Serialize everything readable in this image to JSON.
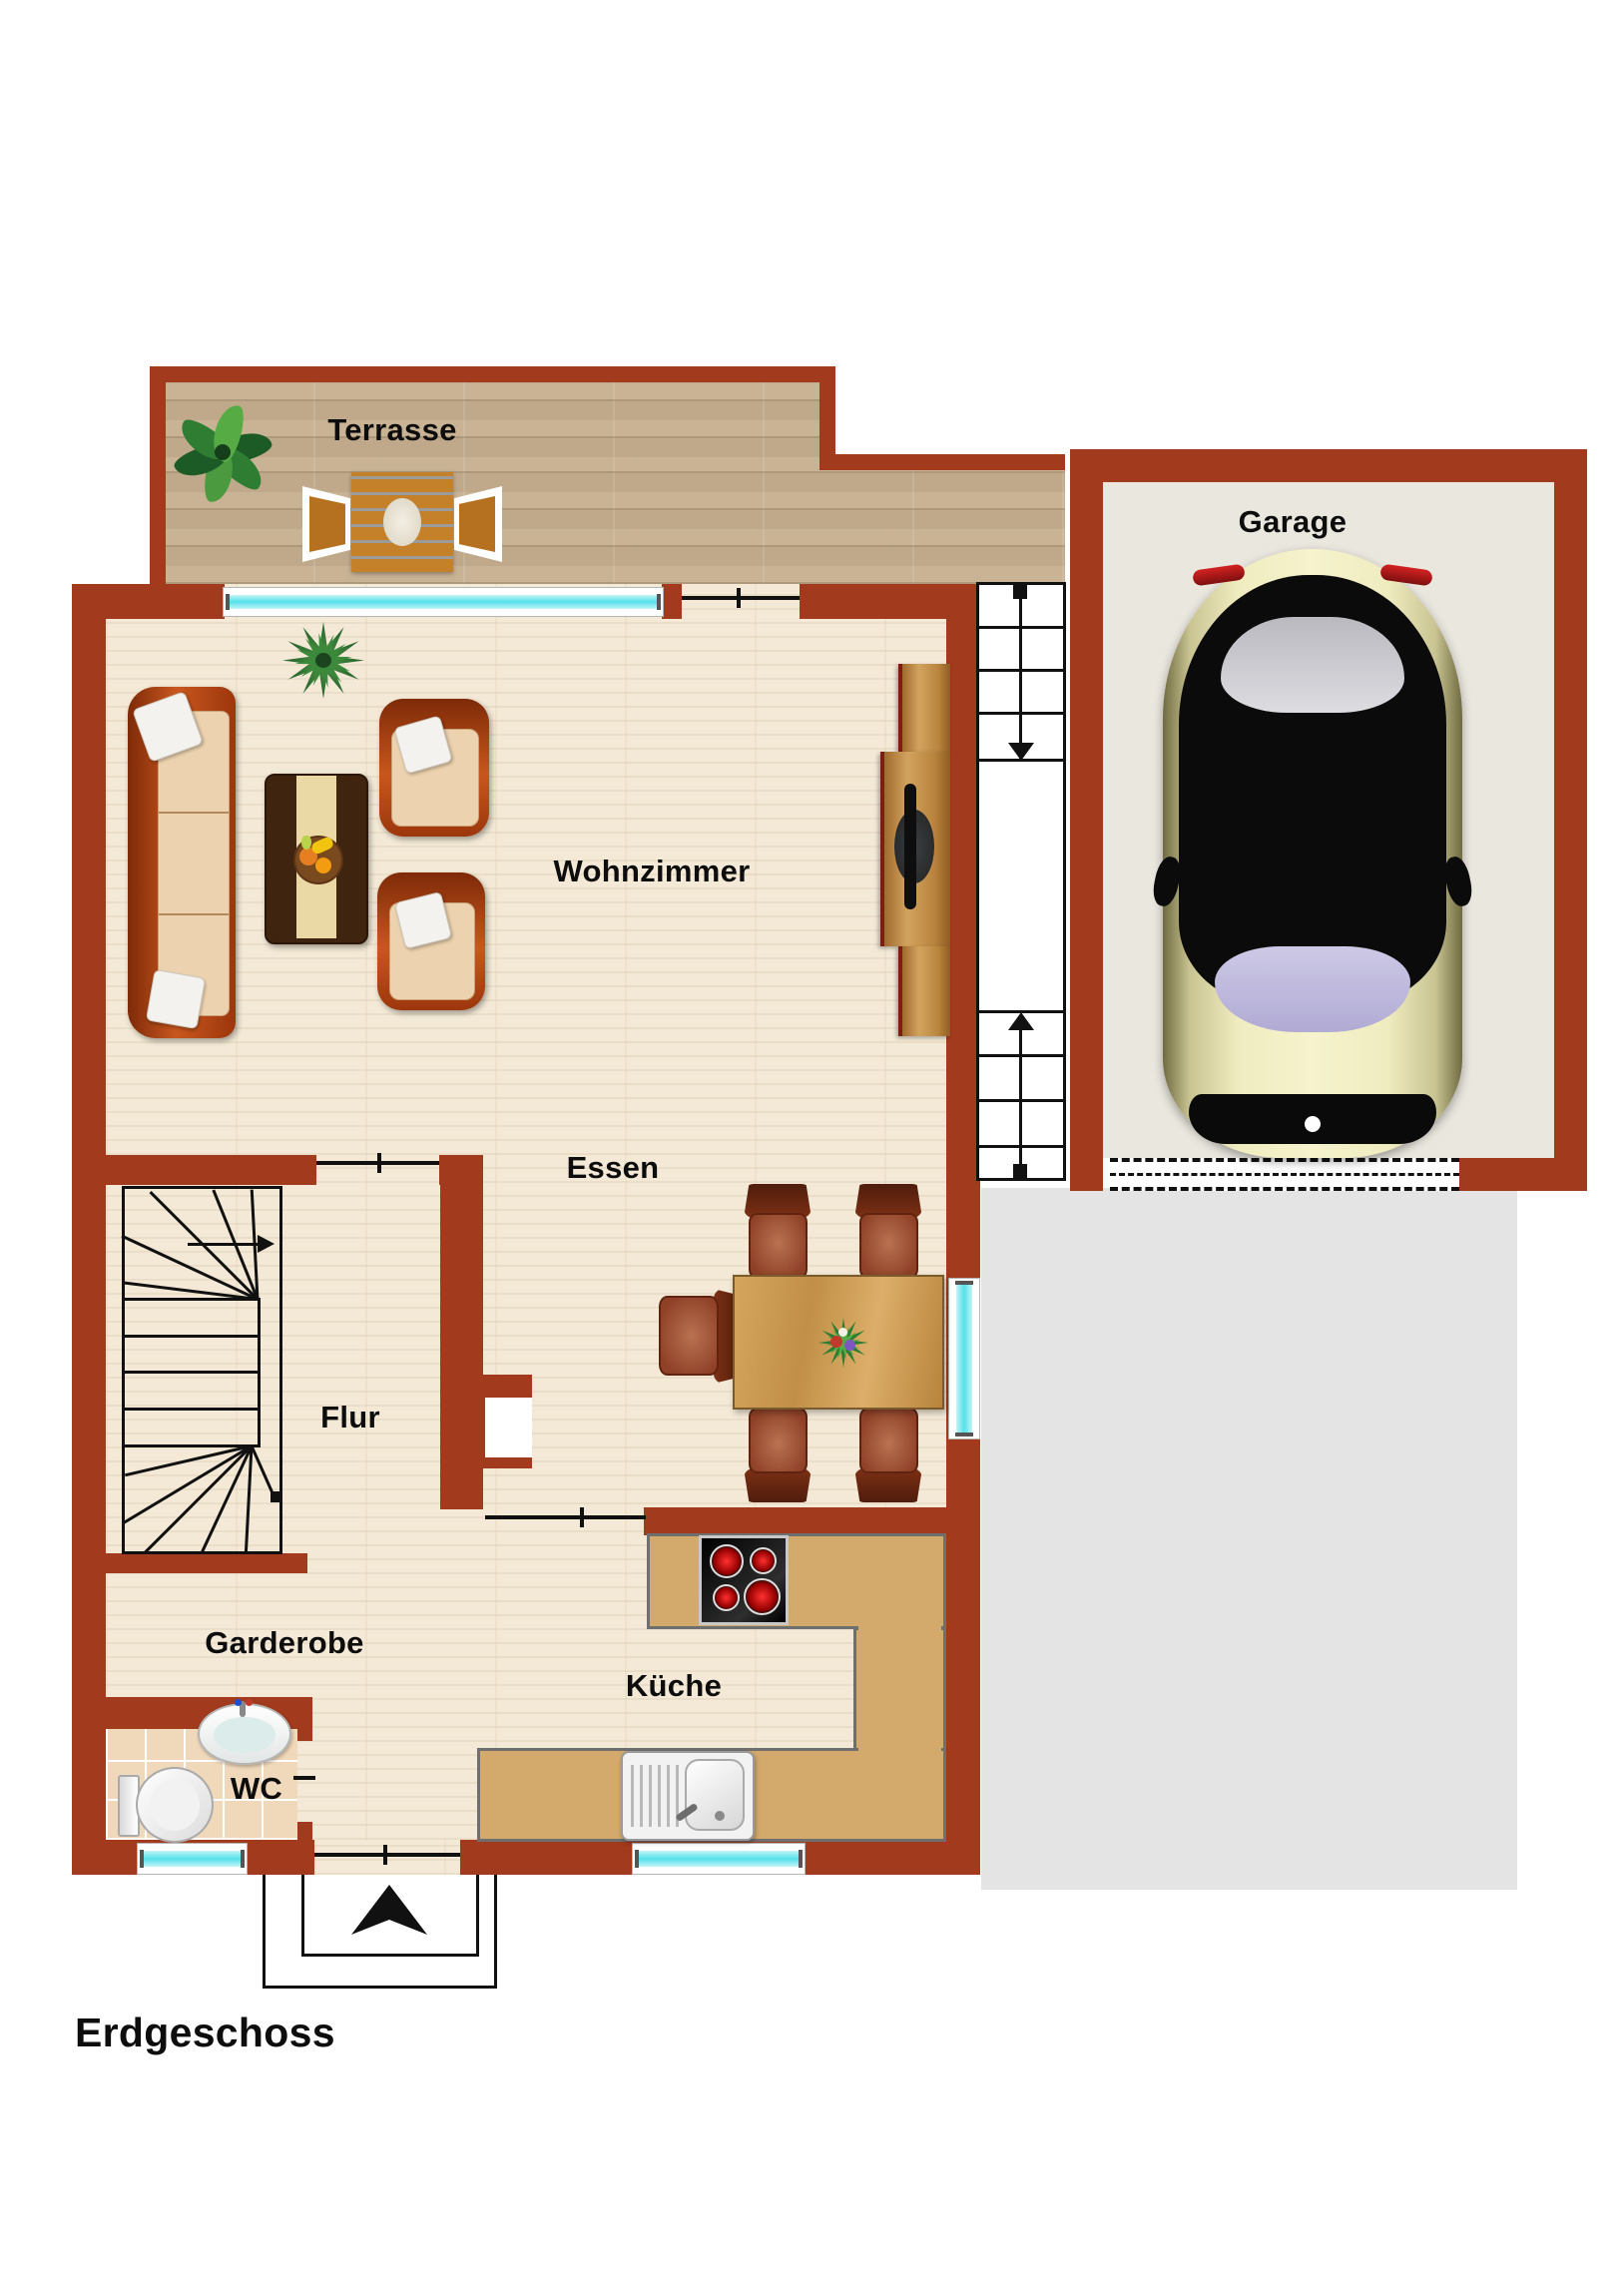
{
  "floor_title": "Erdgeschoss",
  "rooms": {
    "terrasse": "Terrasse",
    "garage": "Garage",
    "wohnzimmer": "Wohnzimmer",
    "essen": "Essen",
    "flur": "Flur",
    "garderobe": "Garderobe",
    "wc": "WC",
    "kueche": "Küche"
  },
  "colors": {
    "wall": "#a23a1d",
    "interior_floor": "#f3e9d6",
    "terrace_wood": "#c6ae8e",
    "garage_floor": "#eae7df",
    "driveway": "#e4e4e4",
    "window_glass": "#55e1ea",
    "counter": "#d4a96c",
    "label_text": "#0d0d0d"
  },
  "icons": {
    "sofa-icon": "three-seat sofa, rust frame, beige cushions",
    "armchair-icon": "rust armchair with white pillow",
    "coffee-table-icon": "dark table with runner and fruit bowl",
    "tv-sideboard-icon": "wood sideboard with flat tv",
    "dining-table-icon": "oak table with flower centerpiece",
    "dining-chair-icon": "brown dining chair",
    "terrace-table-icon": "wood slat table with plate",
    "terrace-chair-icon": "white frame patio chair",
    "plant-icon": "green houseplant",
    "stairs-icon": "winder staircase with direction arrow",
    "exterior-stairs-icon": "outdoor steps between house and garage",
    "stove-icon": "cooktop with four red burners",
    "kitchen-sink-icon": "sink with drainboard",
    "wc-toilet-icon": "toilet top view",
    "wc-sink-icon": "oval washbasin",
    "car-icon": "car top view in garage",
    "garage-door-icon": "dashed roller door",
    "entrance-arrow-icon": "black arrow marking entrance",
    "window-icon": "cyan glazing strip",
    "door-threshold-icon": "open doorway line"
  }
}
